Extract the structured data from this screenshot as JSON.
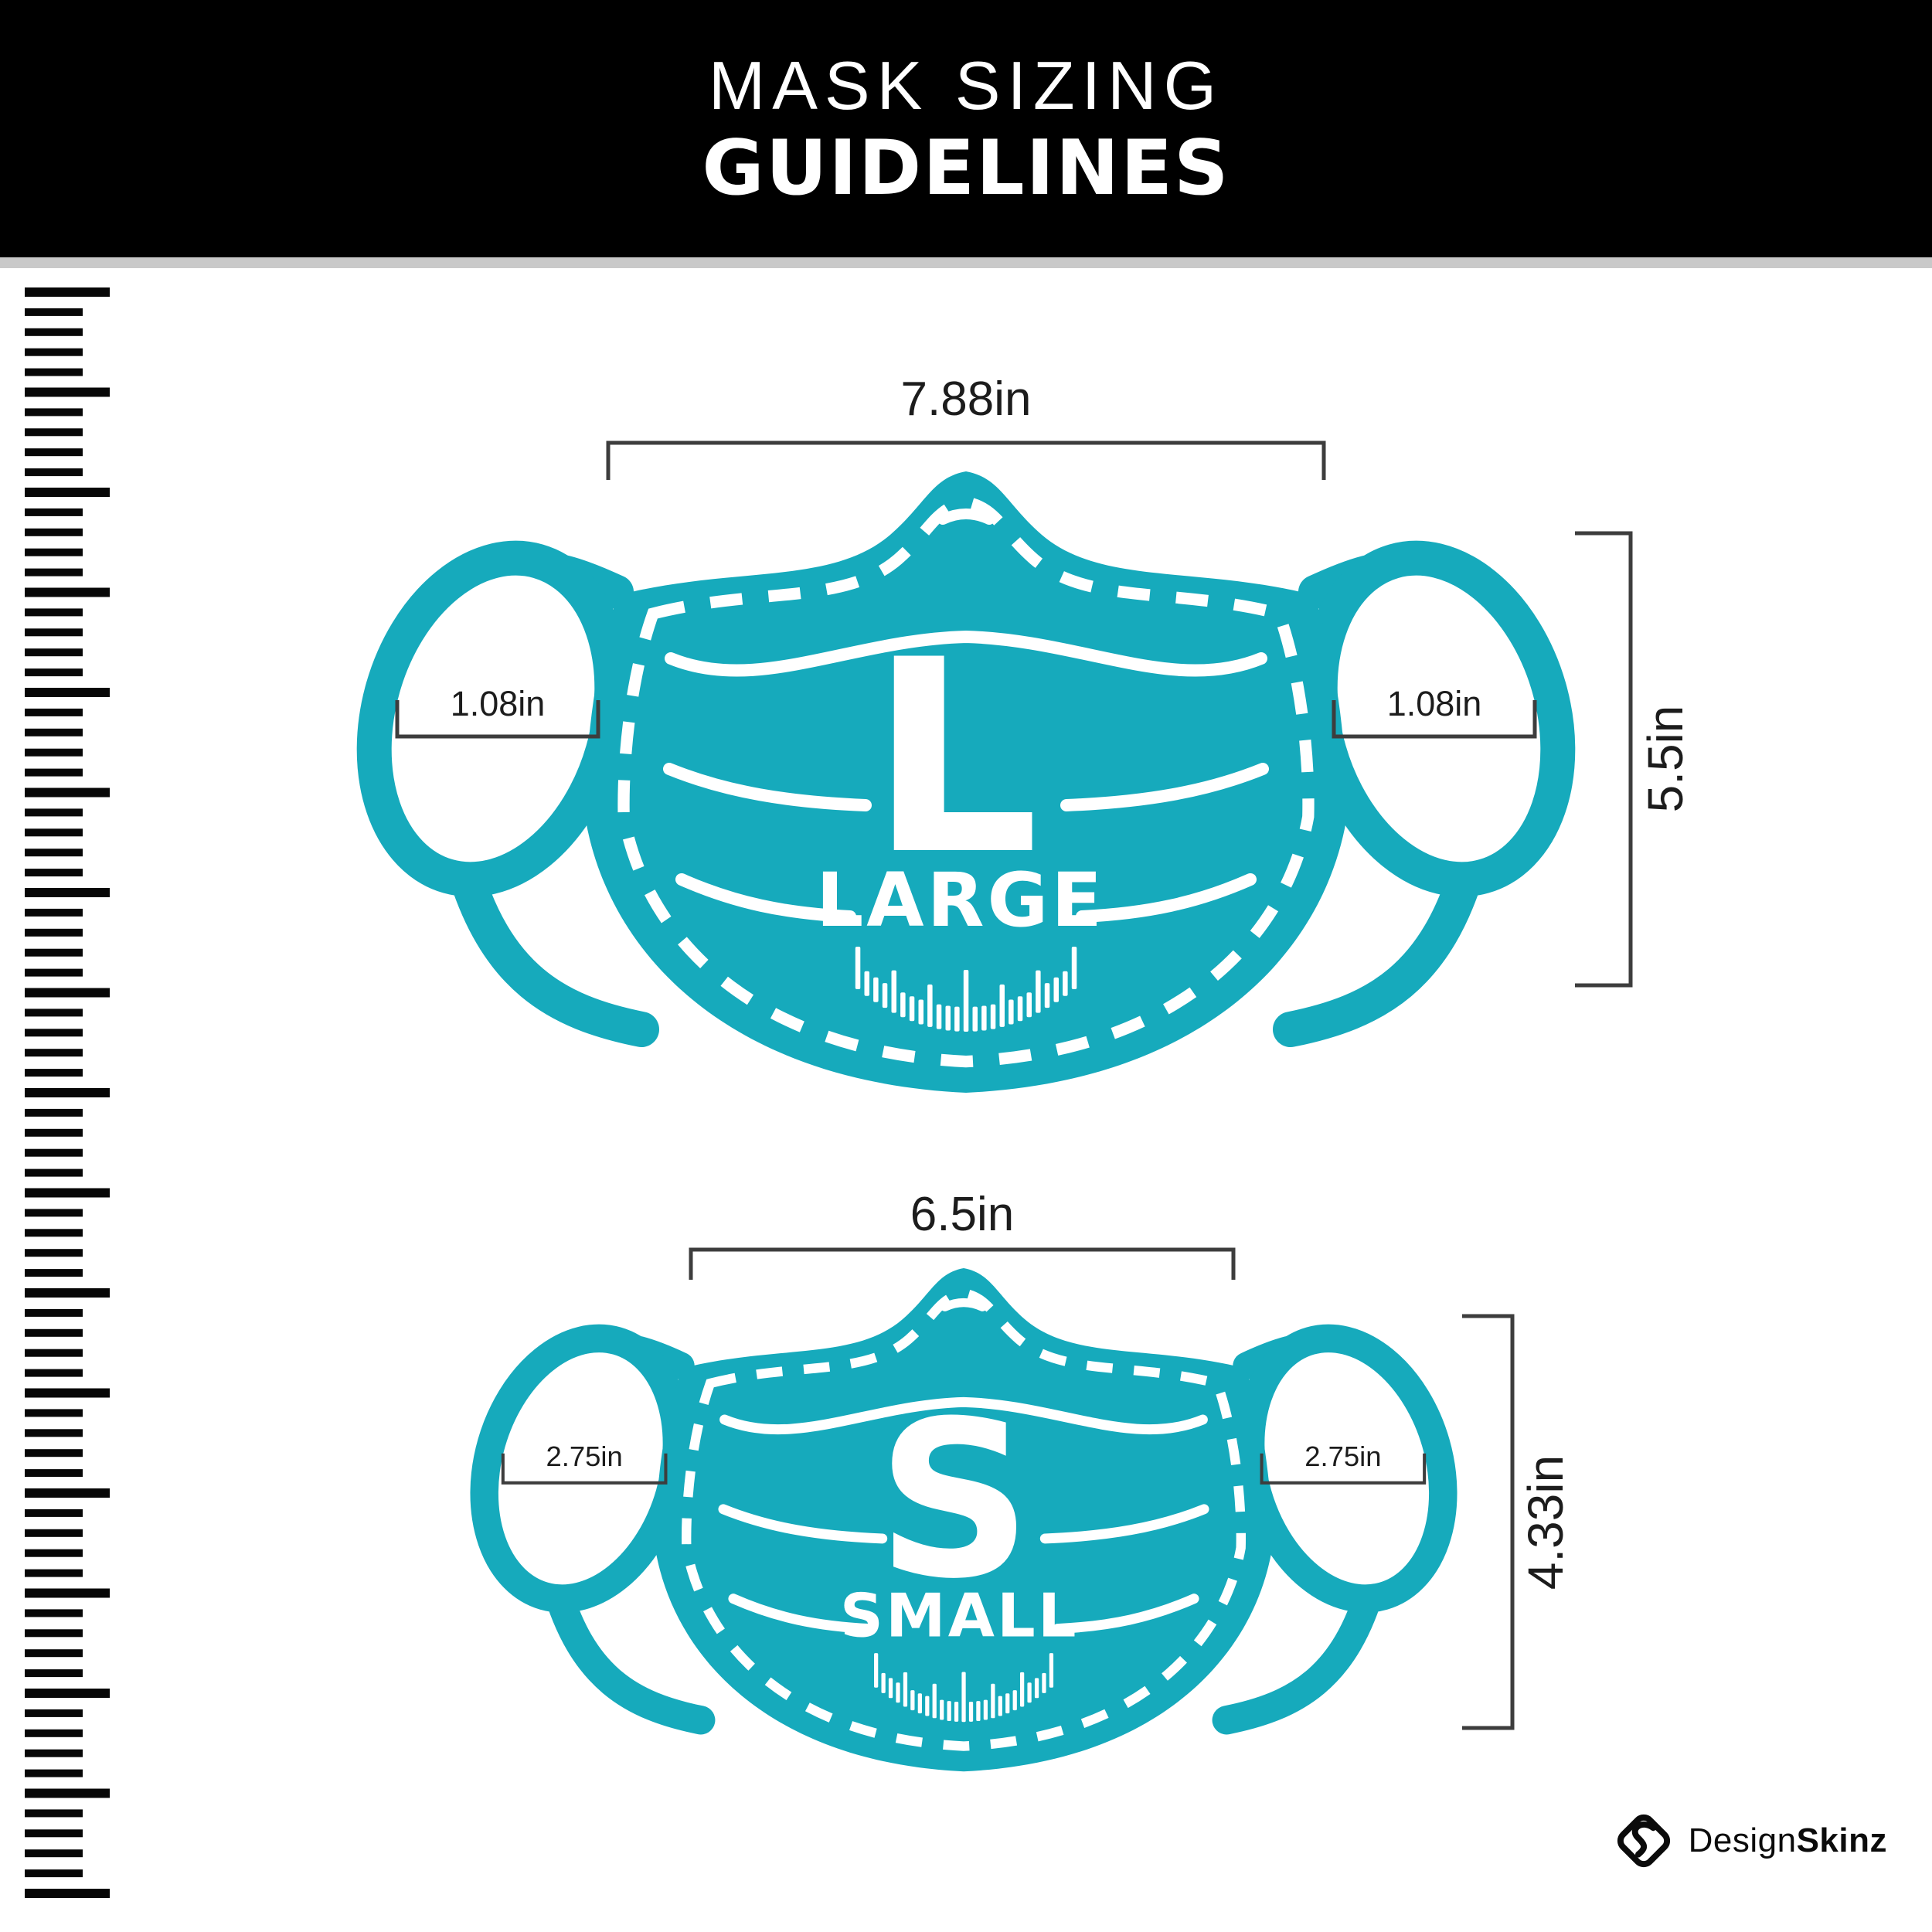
{
  "header": {
    "line1": "MASK SIZING",
    "line2": "GUIDELINES"
  },
  "large_mask": {
    "letter": "L",
    "size_name": "LARGE",
    "width_label": "7.88in",
    "height_label": "5.5in",
    "left_ear_label": "1.08in",
    "right_ear_label": "1.08in"
  },
  "small_mask": {
    "letter": "S",
    "size_name": "SMALL",
    "width_label": "6.5in",
    "height_label": "4.33in",
    "left_ear_label": "2.75in",
    "right_ear_label": "2.75in"
  },
  "logo": {
    "name_regular": "Design",
    "name_bold": "Skinz"
  },
  "colors": {
    "mask_teal": "#16aabc",
    "header_bg": "#000000",
    "divider_gray": "#c9c9c9",
    "bracket_gray": "#3d3d3d",
    "label_dark": "#1c1c1c",
    "ruler_black": "#070707"
  }
}
